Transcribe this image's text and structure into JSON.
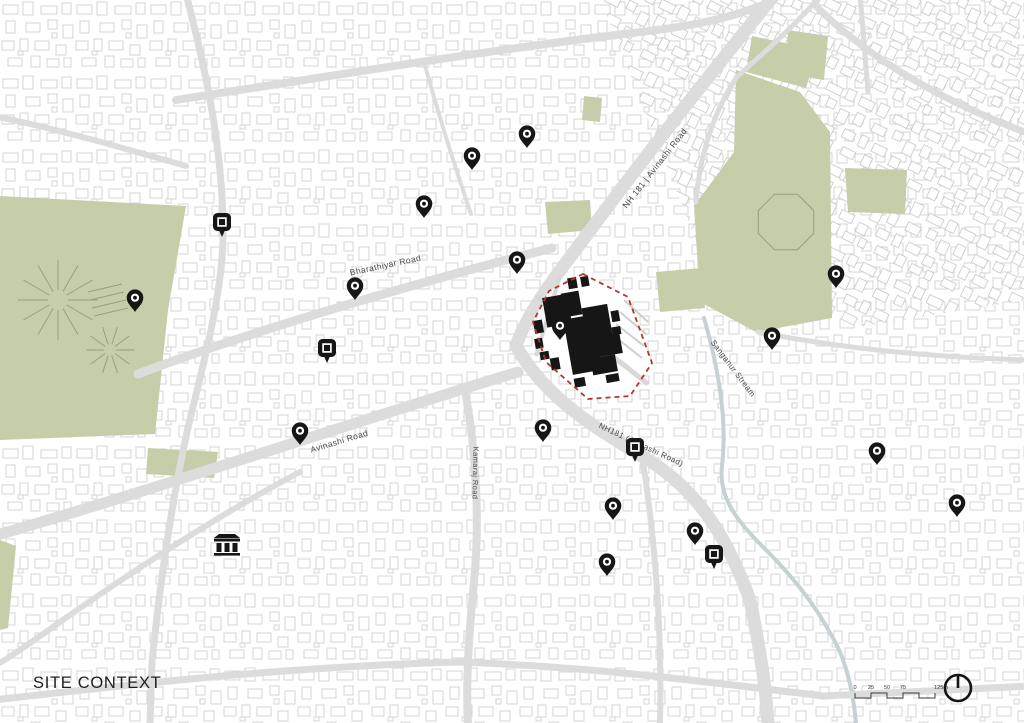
{
  "legend": {
    "title": "SITE CONTEXT",
    "scalebar": {
      "x": 855,
      "y": 698,
      "seg": 16,
      "ticks": [
        "0",
        "25",
        "50",
        "75"
      ],
      "end_label": "125m"
    },
    "north_arrow": {
      "cx": 958,
      "cy": 688,
      "r": 13
    }
  },
  "map": {
    "width": 1024,
    "height": 723,
    "colors": {
      "green": "#c6cda9",
      "park_line": "#97a07c",
      "road": "#dcdcdc",
      "stream": "#c6d1d3",
      "site_boundary": "#b5352a",
      "site_road": "#d8d8d8",
      "pin": "#161616",
      "label": "#474747"
    },
    "labels": [
      {
        "name": "bharathiyar-road",
        "text": "Bharathiyar Road",
        "x": 386,
        "y": 268,
        "r": -12,
        "s": 8.5
      },
      {
        "name": "nh181-avinashi-north",
        "text": "NH 181 | Avinashi Road",
        "x": 657,
        "y": 170,
        "r": -52,
        "s": 8.5
      },
      {
        "name": "avinashi-road-sw",
        "text": "Avinashi Road",
        "x": 340,
        "y": 444,
        "r": -17,
        "s": 8.5
      },
      {
        "name": "kamaraj-road",
        "text": "Kamaraj Road",
        "x": 473,
        "y": 473,
        "r": 91,
        "s": 7.5
      },
      {
        "name": "nh181-avinashi-south",
        "text": "NH181 (Avinashi Road)",
        "x": 640,
        "y": 447,
        "r": 25,
        "s": 8
      },
      {
        "name": "sanganur-stream",
        "text": "Sanganur Stream",
        "x": 731,
        "y": 370,
        "r": 53,
        "s": 8
      }
    ],
    "greens": [
      "0,196 186,206 168,310 155,434 0,440",
      "148,448 218,452 214,478 146,474",
      "0,540 16,546 8,628 0,630",
      "752,36 818,50 806,88 746,72",
      "788,30 828,36 824,80 786,74",
      "736,70 800,92 830,132 832,318 756,332 700,302 694,206 734,152",
      "545,202 590,200 592,230 548,234",
      "656,272 702,268 705,308 660,312",
      "845,168 907,170 905,214 848,212",
      "584,96 602,98 600,122 582,120"
    ],
    "park_decor": {
      "sunbursts": [
        {
          "cx": 58,
          "cy": 300,
          "r": 40,
          "n": 12
        },
        {
          "cx": 110,
          "cy": 350,
          "r": 24,
          "n": 10
        },
        {
          "cx": 340,
          "cy": 522,
          "r": 0,
          "n": 0
        }
      ],
      "octagon": {
        "cx": 786,
        "cy": 222,
        "r": 30
      },
      "bars": [
        [
          88,
          292,
          122,
          284
        ],
        [
          90,
          300,
          124,
          292
        ],
        [
          92,
          308,
          126,
          300
        ],
        [
          94,
          316,
          128,
          308
        ]
      ]
    },
    "stream": "M 704,318 C 716,360 728,414 722,466 C 718,500 740,524 768,552 C 800,584 824,618 840,652 C 850,676 854,700 856,724",
    "roads": [
      {
        "d": "M 775,-6 C 712,72 648,152 592,228 C 562,268 528,310 516,346",
        "w": 13
      },
      {
        "d": "M 516,346 C 542,392 584,422 642,456 C 700,490 728,540 750,600 C 760,648 766,688 768,724",
        "w": 13
      },
      {
        "d": "M 138,374 C 260,328 420,282 552,248",
        "w": 9
      },
      {
        "d": "M -6,536 C 160,488 360,420 518,372",
        "w": 11
      },
      {
        "d": "M 466,396 C 476,452 480,520 474,582 C 468,642 466,690 468,724",
        "w": 8
      },
      {
        "d": "M 176,100 C 330,76 490,50 624,34 C 688,27 724,20 760,6",
        "w": 8
      },
      {
        "d": "M 822,-6 C 786,36 752,62 736,78 C 714,112 700,152 696,202",
        "w": 5
      },
      {
        "d": "M 186,-6 C 208,78 224,158 223,240 C 221,302 202,368 187,432 C 172,502 160,582 152,662 L 150,724",
        "w": 7
      },
      {
        "d": "M -6,116 C 62,130 130,150 186,166",
        "w": 6
      },
      {
        "d": "M -6,700 C 150,682 300,666 462,662 C 606,668 706,682 824,696 L 1030,686",
        "w": 7
      },
      {
        "d": "M 1030,134 C 938,100 866,56 816,6",
        "w": 7
      },
      {
        "d": "M 758,332 C 850,350 946,358 1030,360",
        "w": 5
      },
      {
        "d": "M 860,-6 L 868,92",
        "w": 5
      },
      {
        "d": "M 300,472 C 220,514 140,566 60,622 C 32,642 6,660 -6,666",
        "w": 6
      },
      {
        "d": "M 642,456 C 656,544 662,634 660,724",
        "w": 6
      },
      {
        "d": "M 424,62 C 440,120 456,170 471,214",
        "w": 4
      }
    ],
    "site": {
      "boundary": "583,274 628,297 652,363 630,396 588,399 546,362 533,322 549,291",
      "rotate": -10,
      "rotate_cx": 586,
      "rotate_cy": 334,
      "buildings": [
        [
          549,
          291,
          25,
          30
        ],
        [
          568,
          290,
          18,
          24
        ],
        [
          566,
          316,
          30,
          56
        ],
        [
          586,
          308,
          26,
          34
        ],
        [
          594,
          339,
          25,
          20
        ],
        [
          586,
          359,
          25,
          17
        ],
        [
          577,
          276,
          9,
          11
        ],
        [
          590,
          277,
          8,
          10
        ],
        [
          536,
          312,
          9,
          13
        ],
        [
          534,
          330,
          8,
          10
        ],
        [
          537,
          344,
          9,
          8
        ],
        [
          614,
          316,
          8,
          11
        ],
        [
          612,
          332,
          9,
          8
        ],
        [
          566,
          376,
          11,
          9
        ],
        [
          598,
          378,
          13,
          8
        ],
        [
          546,
          352,
          9,
          12
        ]
      ],
      "inner_roads": [
        {
          "d": "M 536,296 L 648,384",
          "w": 5
        },
        {
          "d": "M 560,276 L 536,356",
          "w": 4
        }
      ],
      "stripes": [
        [
          624,
          300,
          648,
          322
        ],
        [
          620,
          312,
          646,
          334
        ],
        [
          616,
          324,
          644,
          346
        ],
        [
          614,
          336,
          642,
          358
        ]
      ]
    },
    "pins": {
      "dot": [
        [
          527,
          148
        ],
        [
          472,
          170
        ],
        [
          424,
          218
        ],
        [
          517,
          274
        ],
        [
          355,
          300
        ],
        [
          135,
          312
        ],
        [
          836,
          288
        ],
        [
          772,
          350
        ],
        [
          560,
          340
        ],
        [
          300,
          445
        ],
        [
          543,
          442
        ],
        [
          877,
          465
        ],
        [
          957,
          517
        ],
        [
          613,
          520
        ],
        [
          695,
          545
        ],
        [
          607,
          576
        ]
      ],
      "square": [
        [
          222,
          237
        ],
        [
          327,
          363
        ],
        [
          635,
          462
        ],
        [
          714,
          569
        ]
      ]
    },
    "landmark": {
      "type": "classical-building",
      "x": 227,
      "y": 546
    }
  }
}
